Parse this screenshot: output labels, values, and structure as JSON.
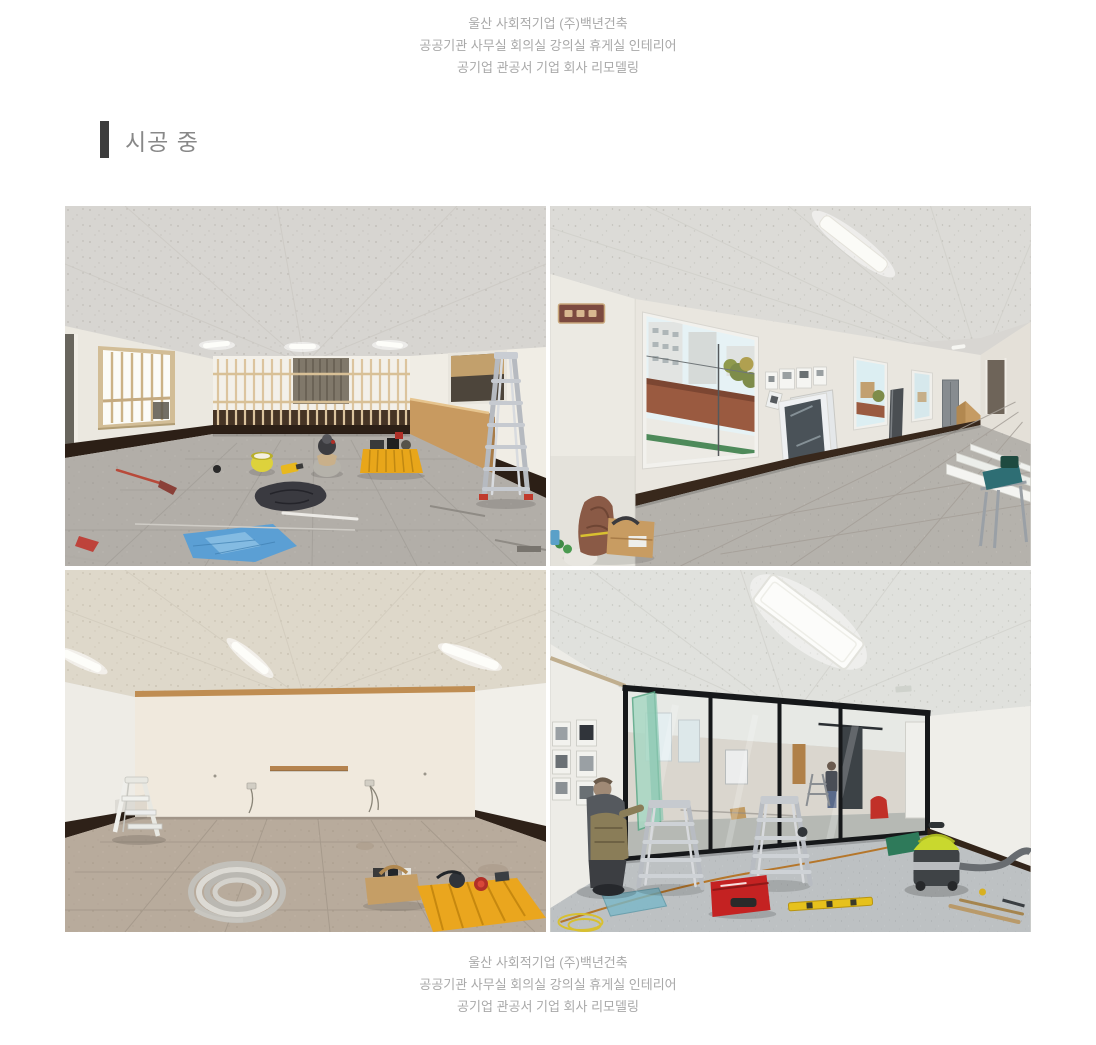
{
  "page": {
    "background": "#ffffff"
  },
  "header_caption": {
    "text_color": "#a9a9a9",
    "lines": [
      "울산 사회적기업 (주)백년건축",
      "공공기관 사무실 회의실 강의실 휴게실 인테리어",
      "공기업 관공서 기업 회사 리모델링"
    ]
  },
  "section_heading": {
    "label": "시공 중",
    "bar_color": "#3d3d3d",
    "text_color": "#888888"
  },
  "gallery": {
    "photos": [
      {
        "alt": "공사 중인 사무실 - 목재 스터드 벽체, 사다리, 바닥의 공구와 자재"
      },
      {
        "alt": "창밖으로 건물이 보이는 사무실 - 벽에 기대 놓은 문짝과 자재"
      },
      {
        "alt": "비어 있는 사무실 - 흰색 사다리와 전선 코일, 공구 바구니"
      },
      {
        "alt": "검은 프레임 유리 칸막이 시공 중 - 사다리, 작업자, 청소기, 공구"
      }
    ]
  },
  "footer_caption": {
    "text_color": "#a9a9a9",
    "lines": [
      "울산 사회적기업 (주)백년건축",
      "공공기관 사무실 회의실 강의실 휴게실 인테리어",
      "공기업 관공서 기업 회사 리모델링"
    ]
  }
}
